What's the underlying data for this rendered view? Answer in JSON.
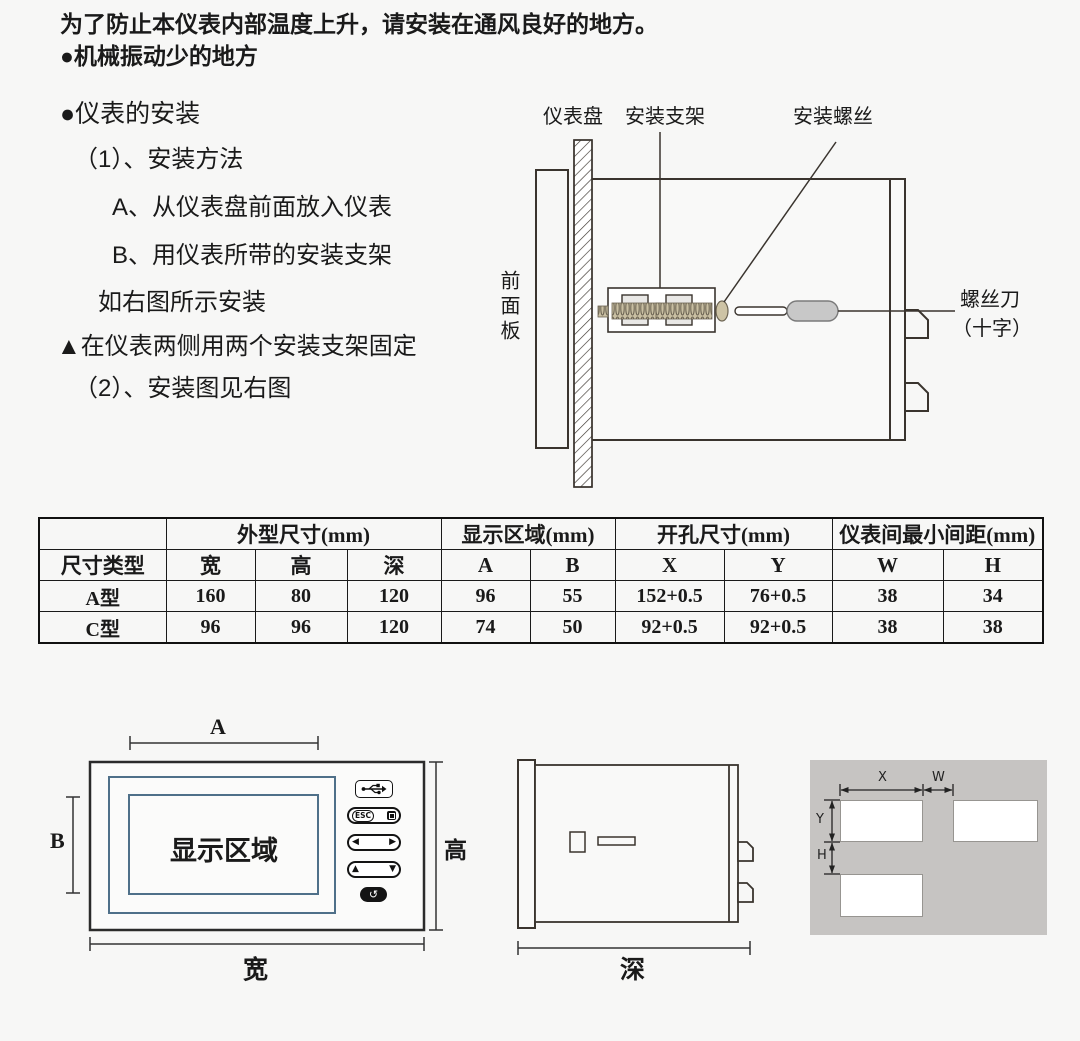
{
  "intro": {
    "line1": "为了防止本仪表内部温度上升，请安装在通风良好的地方。",
    "line2": "●机械振动少的地方"
  },
  "install_steps": {
    "title": "●仪表的安装",
    "step1": "（1）、安装方法",
    "step1a": "A、从仪表盘前面放入仪表",
    "step1b": "B、用仪表所带的安装支架",
    "step1c": "如右图所示安装",
    "note": "▲在仪表两侧用两个安装支架固定",
    "step2": "（2）、安装图见右图"
  },
  "install_diagram": {
    "panel_label": "仪表盘",
    "bracket_label": "安装支架",
    "screw_label": "安装螺丝",
    "front_panel_label": "前面板",
    "screwdriver_label_line1": "螺丝刀",
    "screwdriver_label_line2": "（十字）"
  },
  "dimensions_table": {
    "groups": {
      "outline": "外型尺寸(mm)",
      "display": "显示区域(mm)",
      "cutout": "开孔尺寸(mm)",
      "spacing": "仪表间最小间距(mm)"
    },
    "headers": [
      "尺寸类型",
      "宽",
      "高",
      "深",
      "A",
      "B",
      "X",
      "Y",
      "W",
      "H"
    ],
    "rows": [
      [
        "A型",
        "160",
        "80",
        "120",
        "96",
        "55",
        "152+0.5",
        "76+0.5",
        "38",
        "34"
      ],
      [
        "C型",
        "96",
        "96",
        "120",
        "74",
        "50",
        "92+0.5",
        "92+0.5",
        "38",
        "38"
      ]
    ]
  },
  "front_view": {
    "dim_top": "A",
    "dim_left": "B",
    "dim_right": "高",
    "dim_bottom": "宽",
    "display_area_label": "显示区域",
    "buttons": {
      "esc": "ESC",
      "left": "◀",
      "right": "▶",
      "up": "▲",
      "down": "▼",
      "enter": "↺"
    }
  },
  "side_view": {
    "dim_bottom": "深"
  },
  "cutout_view": {
    "dim_x": "X",
    "dim_w": "W",
    "dim_y": "Y",
    "dim_h": "H"
  },
  "colors": {
    "line": "#3a342e",
    "steel_blue": "#4f7089",
    "panel_gray": "#c6c4c2",
    "screw_tan": "#c9bfa2",
    "handle_gray": "#c8c8c8"
  }
}
